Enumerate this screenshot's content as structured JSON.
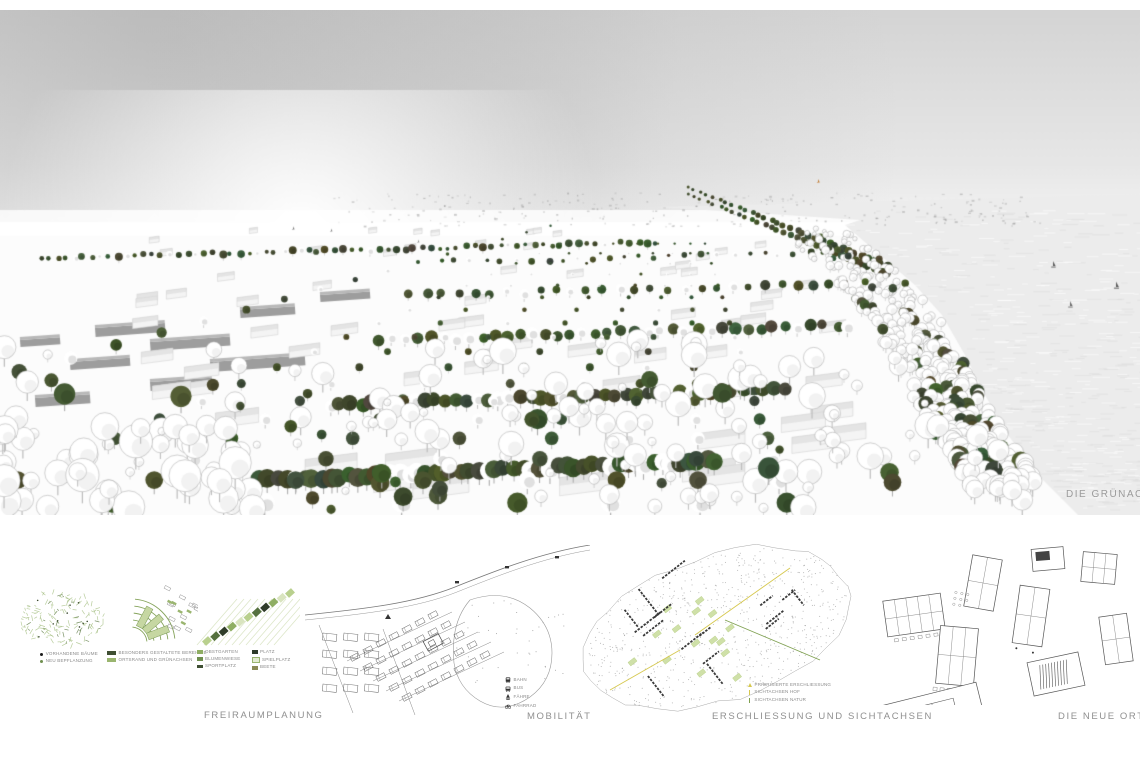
{
  "render": {
    "caption": "DIE GRÜNACHSE",
    "type": "aerial-perspective-rendering",
    "description": "White 3D massing model of a lakeside village with dark green tree rows forming a green axis, grey cloudy sky, water with small sailboats on the right"
  },
  "panels": {
    "freiraumplanung": {
      "title": "FREIRAUMPLANUNG",
      "legend_existing": [
        {
          "marker": "dot",
          "color": "#1c1c1c",
          "label": "VORHANDENE BÄUME"
        },
        {
          "marker": "dot",
          "color": "#6f8f4f",
          "label": "NEU BEPFLANZUNG"
        }
      ],
      "legend_structure": [
        {
          "color": "#3f4f33",
          "label": "BESONDERS GESTALTETE BEREICHE"
        },
        {
          "color": "#9ab56f",
          "label": "ORTSRAND UND GRÜNACHSEN"
        }
      ],
      "legend_uses_col1": [
        {
          "color": "#8fae63",
          "label": "OBSTGARTEN"
        },
        {
          "color": "#6f8f4f",
          "label": "BLUMENWIESE"
        },
        {
          "color": "#3f4f33",
          "label": "SPORTPLATZ"
        }
      ],
      "legend_uses_col2": [
        {
          "color": "#2e3a2a",
          "label": "PLATZ"
        },
        {
          "color": "#e4ecd2",
          "label": "SPIELPLATZ"
        },
        {
          "color": "#8a8a55",
          "label": "BEETE"
        }
      ]
    },
    "mobilitaet": {
      "title": "MOBILITÄT",
      "legend": [
        {
          "icon": "train-icon",
          "label": "BAHN"
        },
        {
          "icon": "bus-icon",
          "label": "BUS"
        },
        {
          "icon": "ferry-icon",
          "label": "FÄHRE"
        },
        {
          "icon": "bicycle-icon",
          "label": "FAHRRAD"
        }
      ]
    },
    "erschliessung": {
      "title": "ERSCHLIESSUNG UND SICHTACHSEN",
      "legend": [
        {
          "marker": "triangle",
          "color": "#d6c84e",
          "label": "PRIORISIERTE ERSCHLIESSUNG"
        },
        {
          "marker": "line",
          "color": "#d6c84e",
          "label": "SICHTACHSEN HOF"
        },
        {
          "marker": "line",
          "color": "#7fa050",
          "label": "SICHTACHSEN NATUR"
        }
      ]
    },
    "ortsmitte": {
      "title": "DIE NEUE ORTSMITTE"
    }
  },
  "colors": {
    "tree_green": "#48563a",
    "water": "#ededed",
    "sky": "#d2d2d2",
    "label_gray": "#909090",
    "legend_text": "#8a8a8a",
    "accent_yellow": "#d6c84e",
    "accent_green": "#7fa050"
  }
}
